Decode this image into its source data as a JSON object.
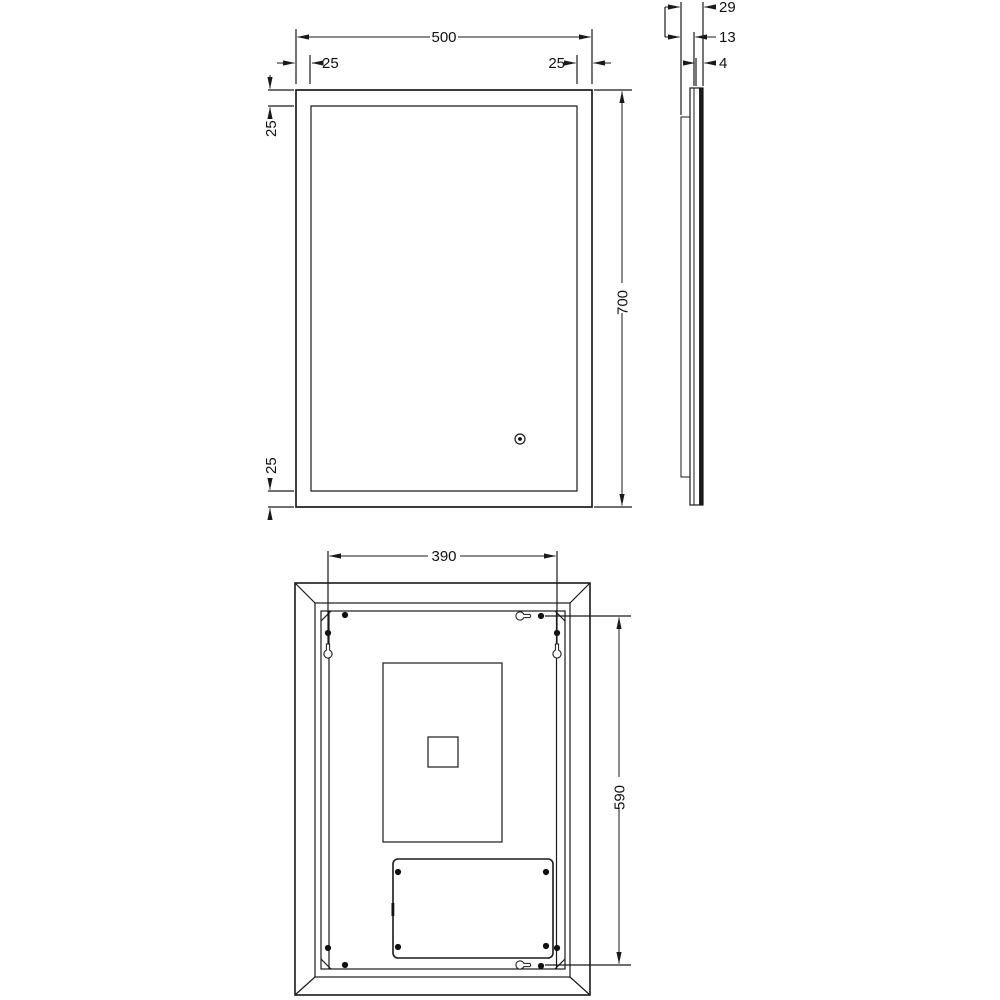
{
  "drawing": {
    "accent_color": "#1a1a1a",
    "background_color": "#ffffff",
    "front_view": {
      "overall_width": "500",
      "overall_height": "700",
      "inset_top_left": "25",
      "inset_top_right": "25",
      "inset_left_upper": "25",
      "inset_left_lower": "25"
    },
    "side_view": {
      "overall_depth": "29",
      "housing_depth": "13",
      "glass_thickness": "4"
    },
    "back_view": {
      "hanger_width": "390",
      "hanger_height": "590"
    }
  }
}
